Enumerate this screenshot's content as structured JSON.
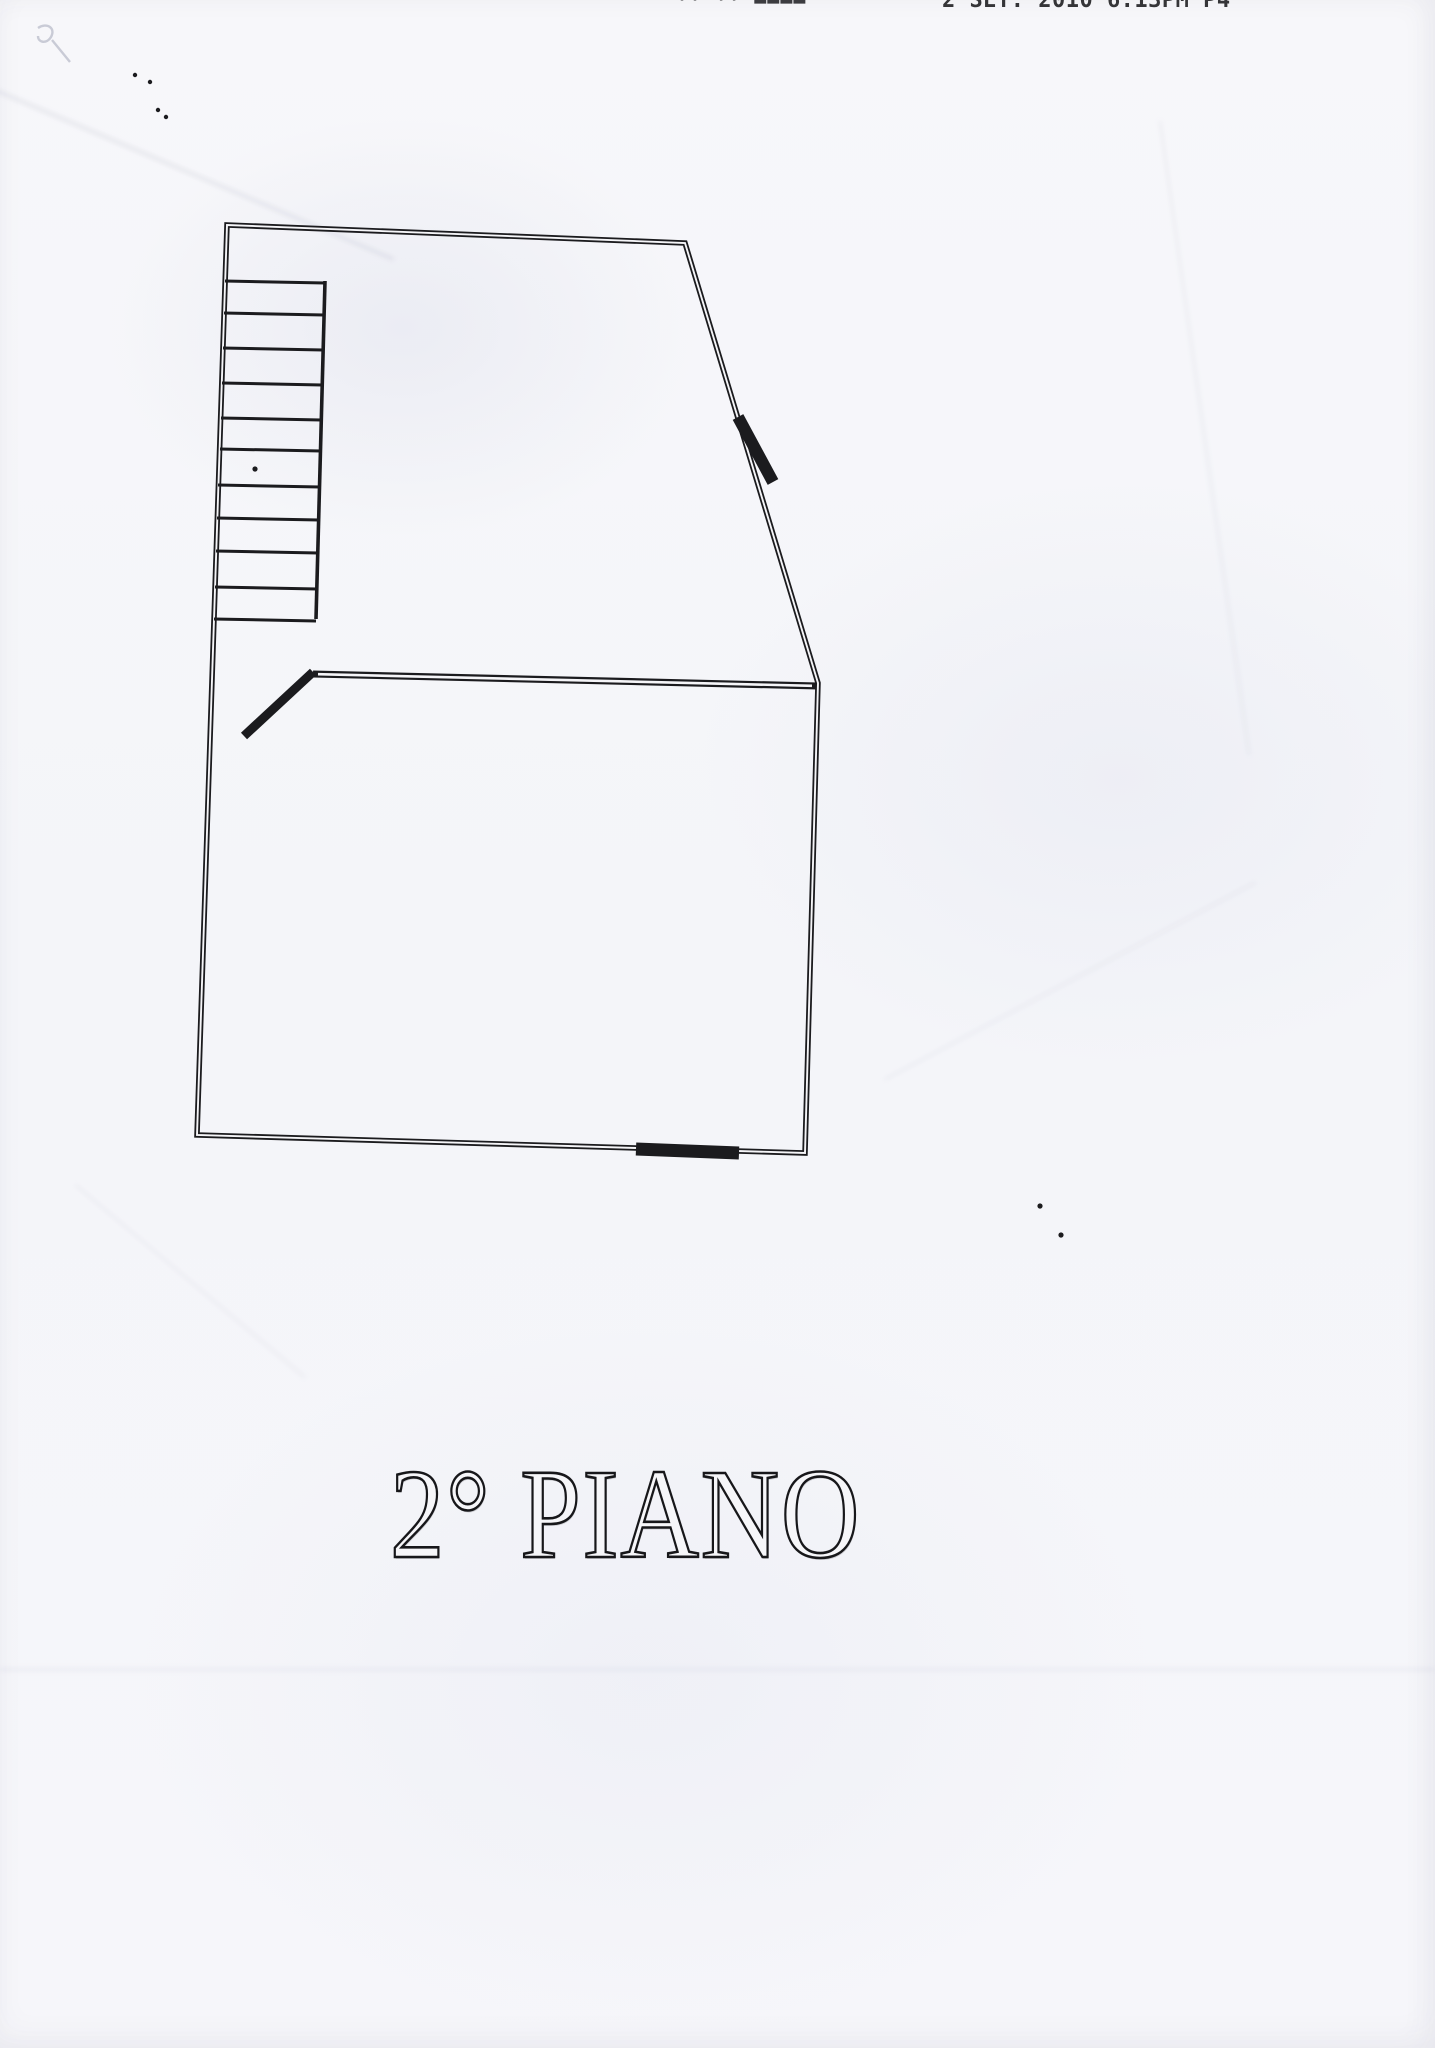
{
  "page": {
    "paper_color": "#f5f5f8",
    "ink_color": "#1b1b1e",
    "pencil_color": "#c9cbd6"
  },
  "fax_header": {
    "left_fragment": "·· ·· ▬▬▬▬",
    "timestamp": "2 SET. 2010  6:13PM  P4"
  },
  "floor_label": {
    "text": "2° PIANO"
  },
  "plan": {
    "outer_boundary": [
      [
        227,
        225
      ],
      [
        685,
        243
      ],
      [
        818,
        683
      ],
      [
        805,
        1153
      ],
      [
        197,
        1135
      ]
    ],
    "interior_wall": [
      [
        313,
        674
      ],
      [
        818,
        686
      ]
    ],
    "door_swing": [
      [
        313,
        672
      ],
      [
        244,
        736
      ]
    ],
    "stairs": {
      "right_edge": [
        [
          325,
          281
        ],
        [
          316,
          619
        ]
      ],
      "treads": [
        [
          281,
          225,
          325
        ],
        [
          313,
          224,
          324
        ],
        [
          348,
          223,
          323
        ],
        [
          383,
          222,
          322
        ],
        [
          418,
          221,
          321
        ],
        [
          449,
          220,
          321
        ],
        [
          485,
          218,
          320
        ],
        [
          518,
          217,
          319
        ],
        [
          551,
          216,
          318
        ],
        [
          587,
          215,
          317
        ],
        [
          619,
          214,
          316
        ]
      ]
    },
    "wall_thick_marks": [
      {
        "name": "diagonal-wall-opening",
        "x1": 738,
        "y1": 417,
        "x2": 773,
        "y2": 482,
        "width": 12
      },
      {
        "name": "bottom-wall-opening",
        "x1": 636,
        "y1": 1149,
        "x2": 739,
        "y2": 1153,
        "width": 13
      }
    ],
    "speckles": [
      [
        135,
        75
      ],
      [
        150,
        82
      ],
      [
        158,
        110
      ],
      [
        166,
        117
      ],
      [
        255,
        469
      ],
      [
        1061,
        1235
      ],
      [
        1040,
        1206
      ]
    ],
    "pencil_mark": {
      "x": 38,
      "y": 28
    }
  }
}
